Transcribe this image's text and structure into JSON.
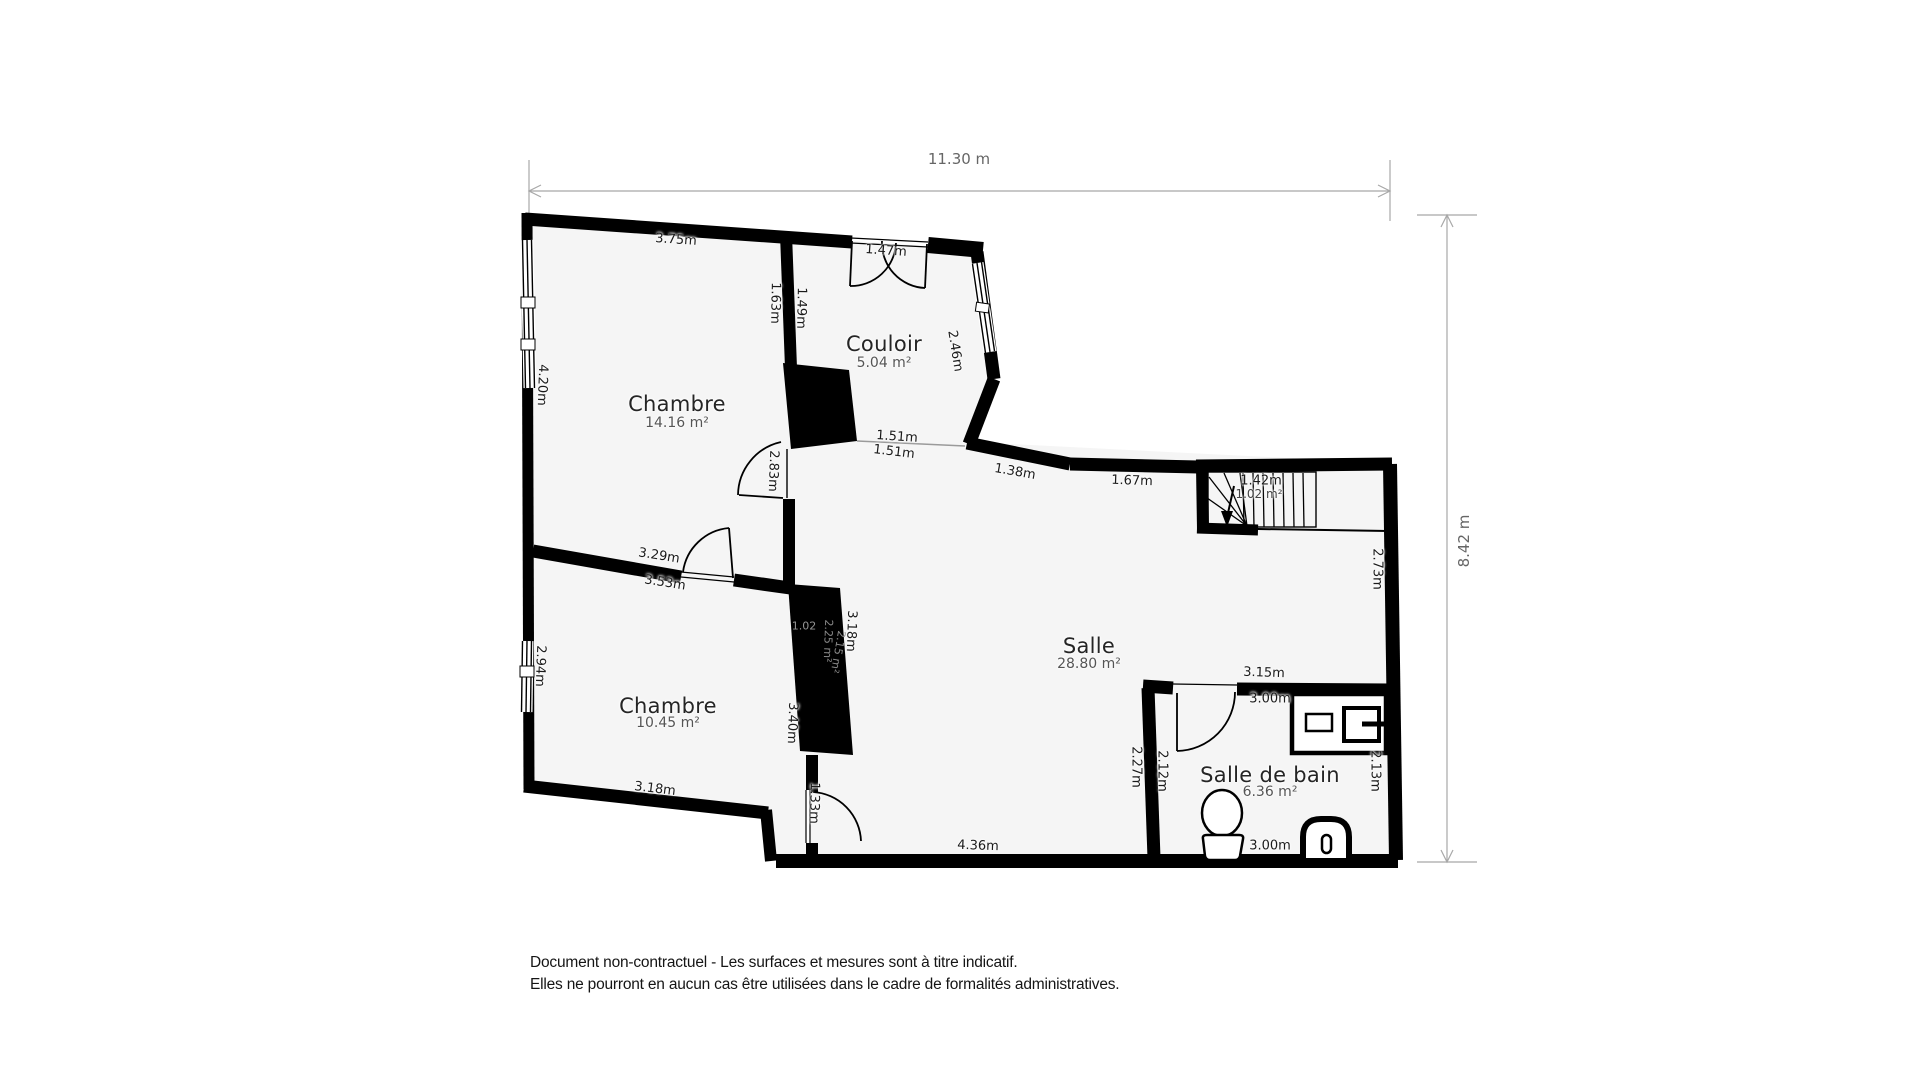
{
  "dimensions": {
    "top": "11.30 m",
    "right": "8.42 m"
  },
  "rooms": {
    "chambre1": {
      "name": "Chambre",
      "area": "14.16 m²"
    },
    "couloir": {
      "name": "Couloir",
      "area": "5.04 m²"
    },
    "salle": {
      "name": "Salle",
      "area": "28.80 m²"
    },
    "chambre2": {
      "name": "Chambre",
      "area": "10.45 m²"
    },
    "salle_de_bain": {
      "name": "Salle de bain",
      "area": "6.36 m²"
    },
    "stairs": {
      "width": "1.42m",
      "area": "1.02 m²"
    },
    "duct": {
      "a": "1.02",
      "b": "2.25 m²",
      "c": "2.15 m²"
    }
  },
  "measurements": {
    "chambre1_top": "3.75m",
    "chambre1_right": "1.63m",
    "couloir_left": "1.49m",
    "entrance_door": "1.47m",
    "couloir_window": "2.46m",
    "chambre1_left": "4.20m",
    "passage_a": "1.51m",
    "passage_b": "1.51m",
    "chambre1_door": "2.83m",
    "divider_top": "3.29m",
    "divider_bottom": "3.53m",
    "salle_top_a": "1.38m",
    "salle_top_b": "1.67m",
    "salle_right": "2.73m",
    "duct_right": "3.18m",
    "chambre2_left": "2.94m",
    "chambre2_right": "3.40m",
    "chambre2_bottom": "3.18m",
    "salle_door": "1.33m",
    "salle_bottom": "4.36m",
    "bath_top_out": "3.15m",
    "bath_top_in": "3.00m",
    "bath_left_out": "2.27m",
    "bath_left_in": "2.12m",
    "bath_right": "2.13m",
    "bath_bottom": "3.00m"
  },
  "footer": {
    "line1": "Document non-contractuel - Les surfaces et mesures sont à titre indicatif.",
    "line2": "Elles ne pourront en aucun cas être utilisées dans le cadre de formalités administratives."
  },
  "colors": {
    "wall": "#000000",
    "floor": "#f5f5f5",
    "dimension": "#a8a8a8"
  }
}
